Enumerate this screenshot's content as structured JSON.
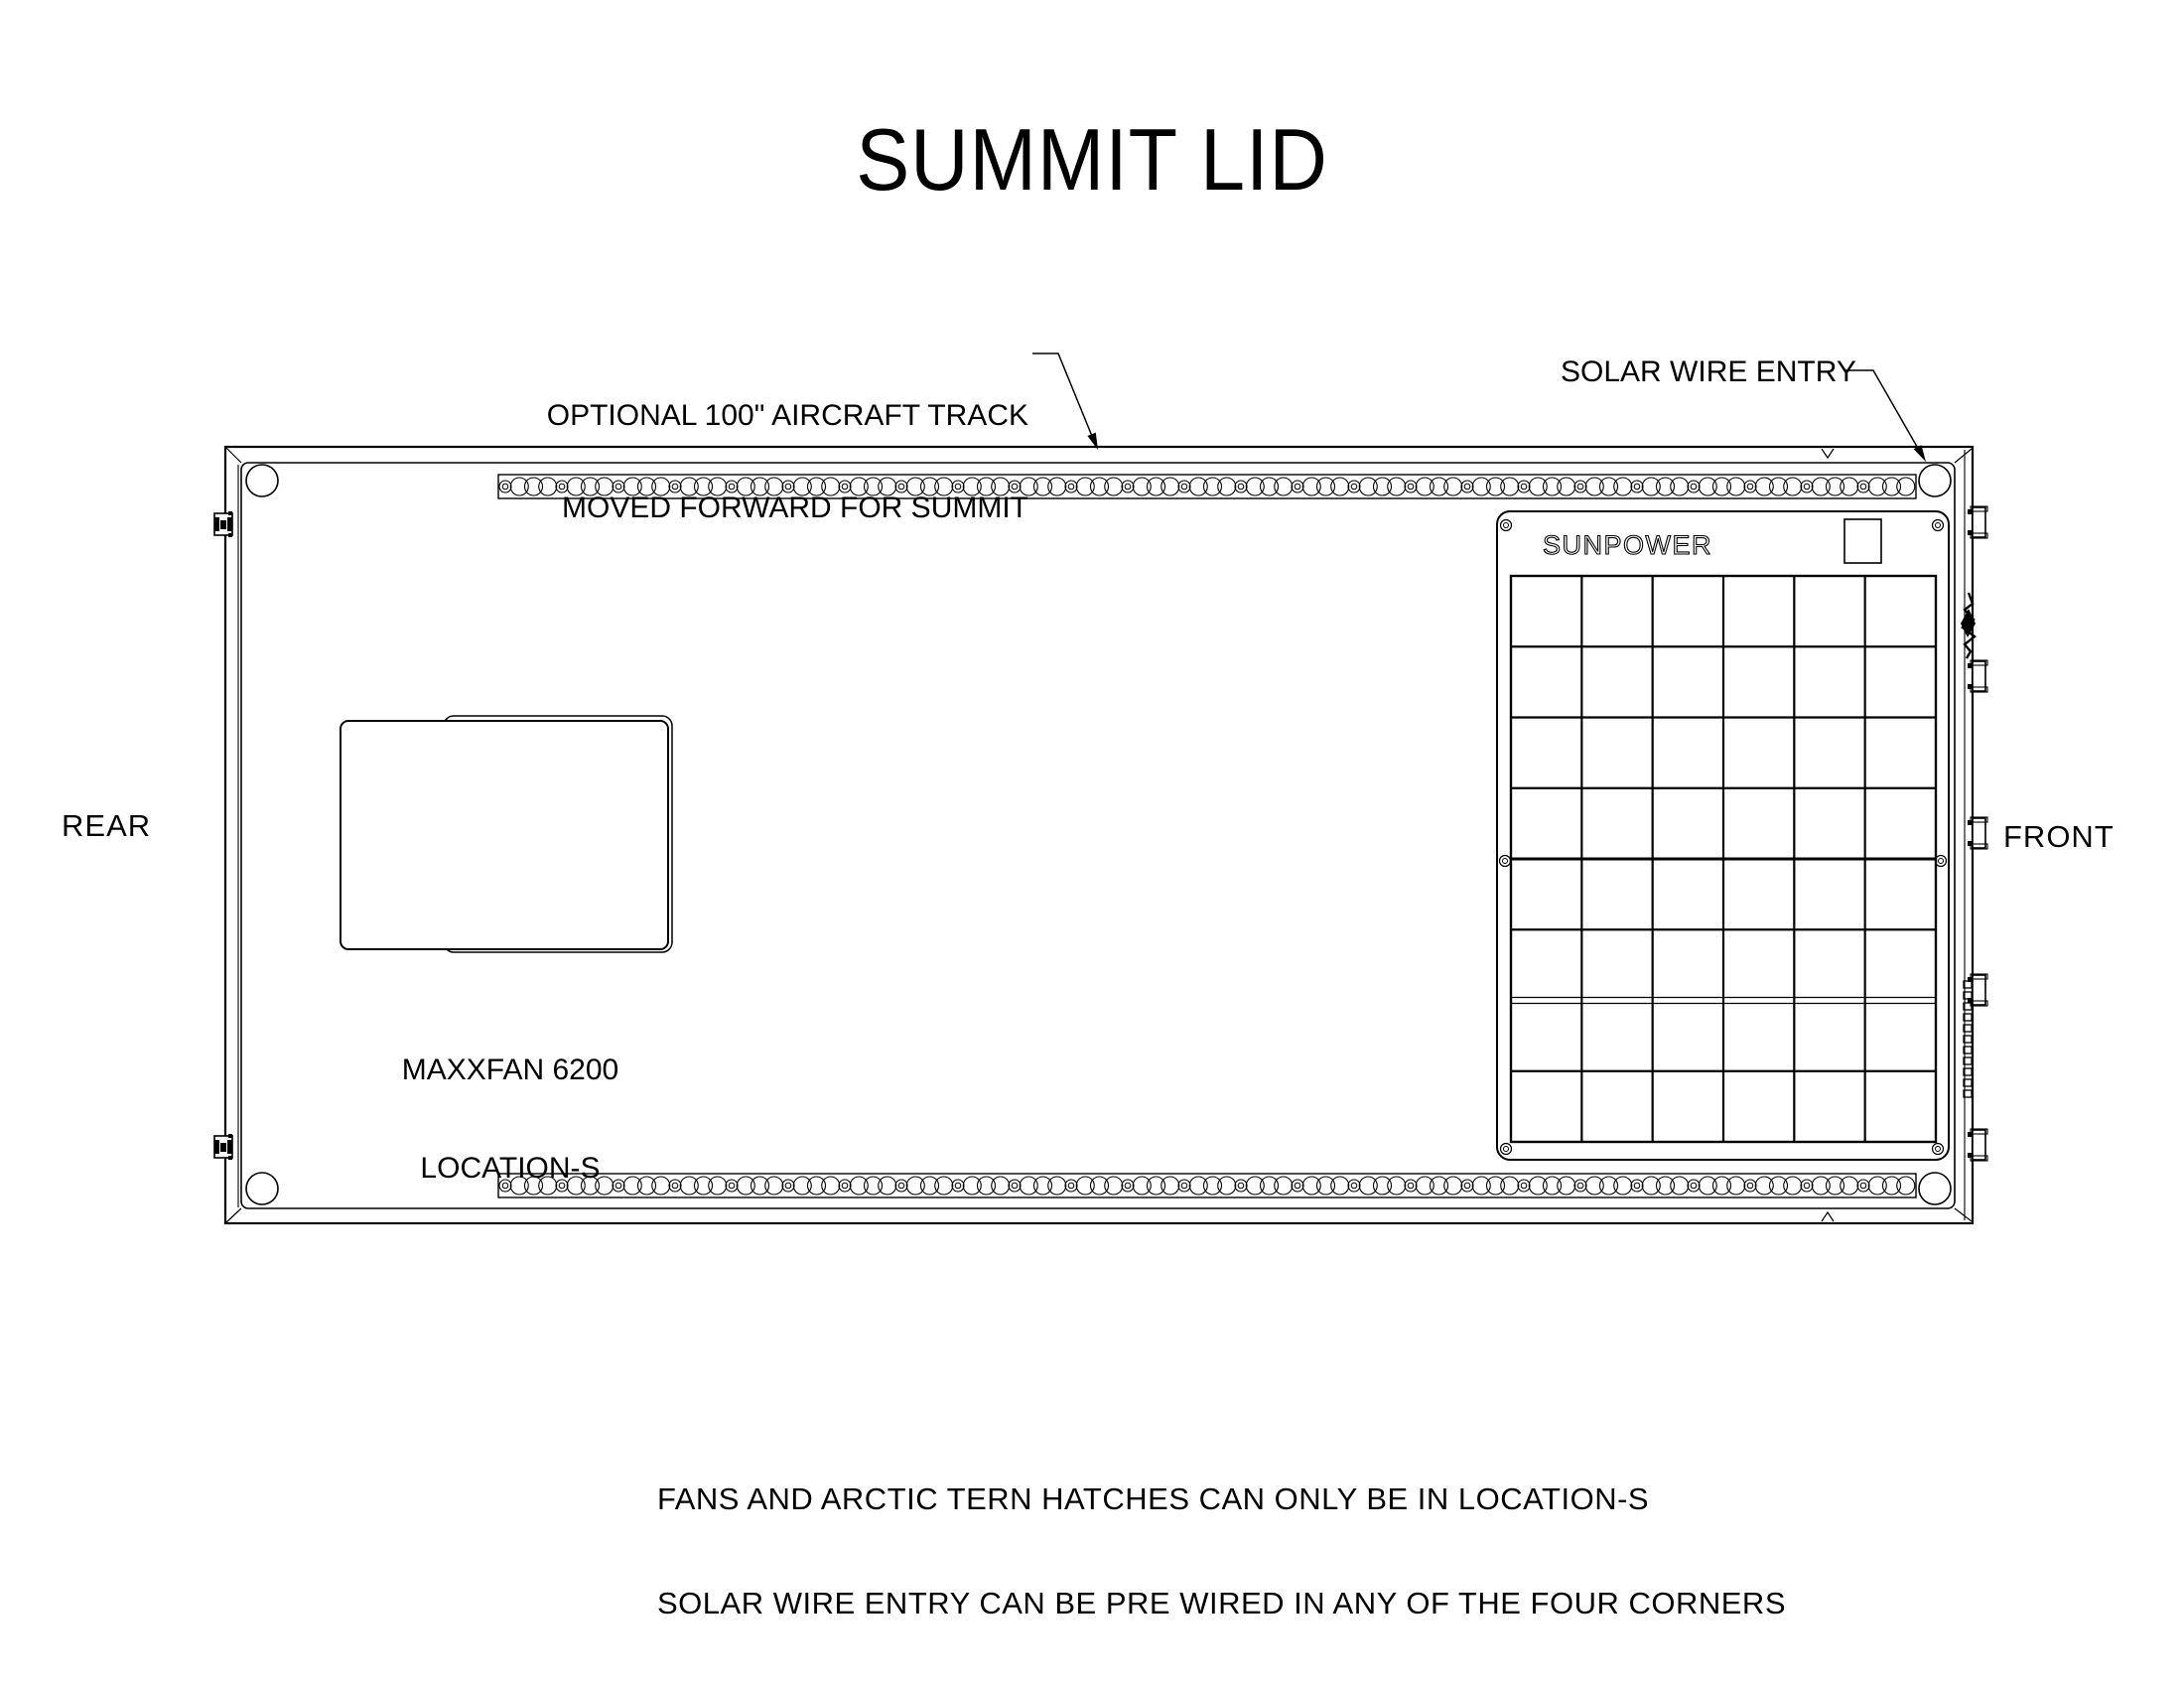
{
  "title": "SUMMIT LID",
  "labels": {
    "aircraft_track_line1": "OPTIONAL 100\" AIRCRAFT TRACK",
    "aircraft_track_line2": "MOVED FORWARD FOR SUMMIT",
    "solar_wire_entry": "SOLAR WIRE ENTRY",
    "rear": "REAR",
    "front": "FRONT",
    "fan_line1": "MAXXFAN 6200",
    "fan_line2": "LOCATION-S",
    "panel_brand": "SUNPOWER"
  },
  "notes": {
    "line1": "FANS AND ARCTIC TERN HATCHES CAN ONLY BE IN LOCATION-S",
    "line2": "SOLAR WIRE ENTRY CAN BE PRE WIRED IN ANY OF THE FOUR CORNERS"
  },
  "drawing": {
    "ink_color": "#000000",
    "background": "#ffffff",
    "solar_panel": {
      "columns": 6,
      "rows": 8
    },
    "aircraft_track_count": 2,
    "hinge_count": 2,
    "latch_count": 5,
    "corner_hole_count": 4
  }
}
